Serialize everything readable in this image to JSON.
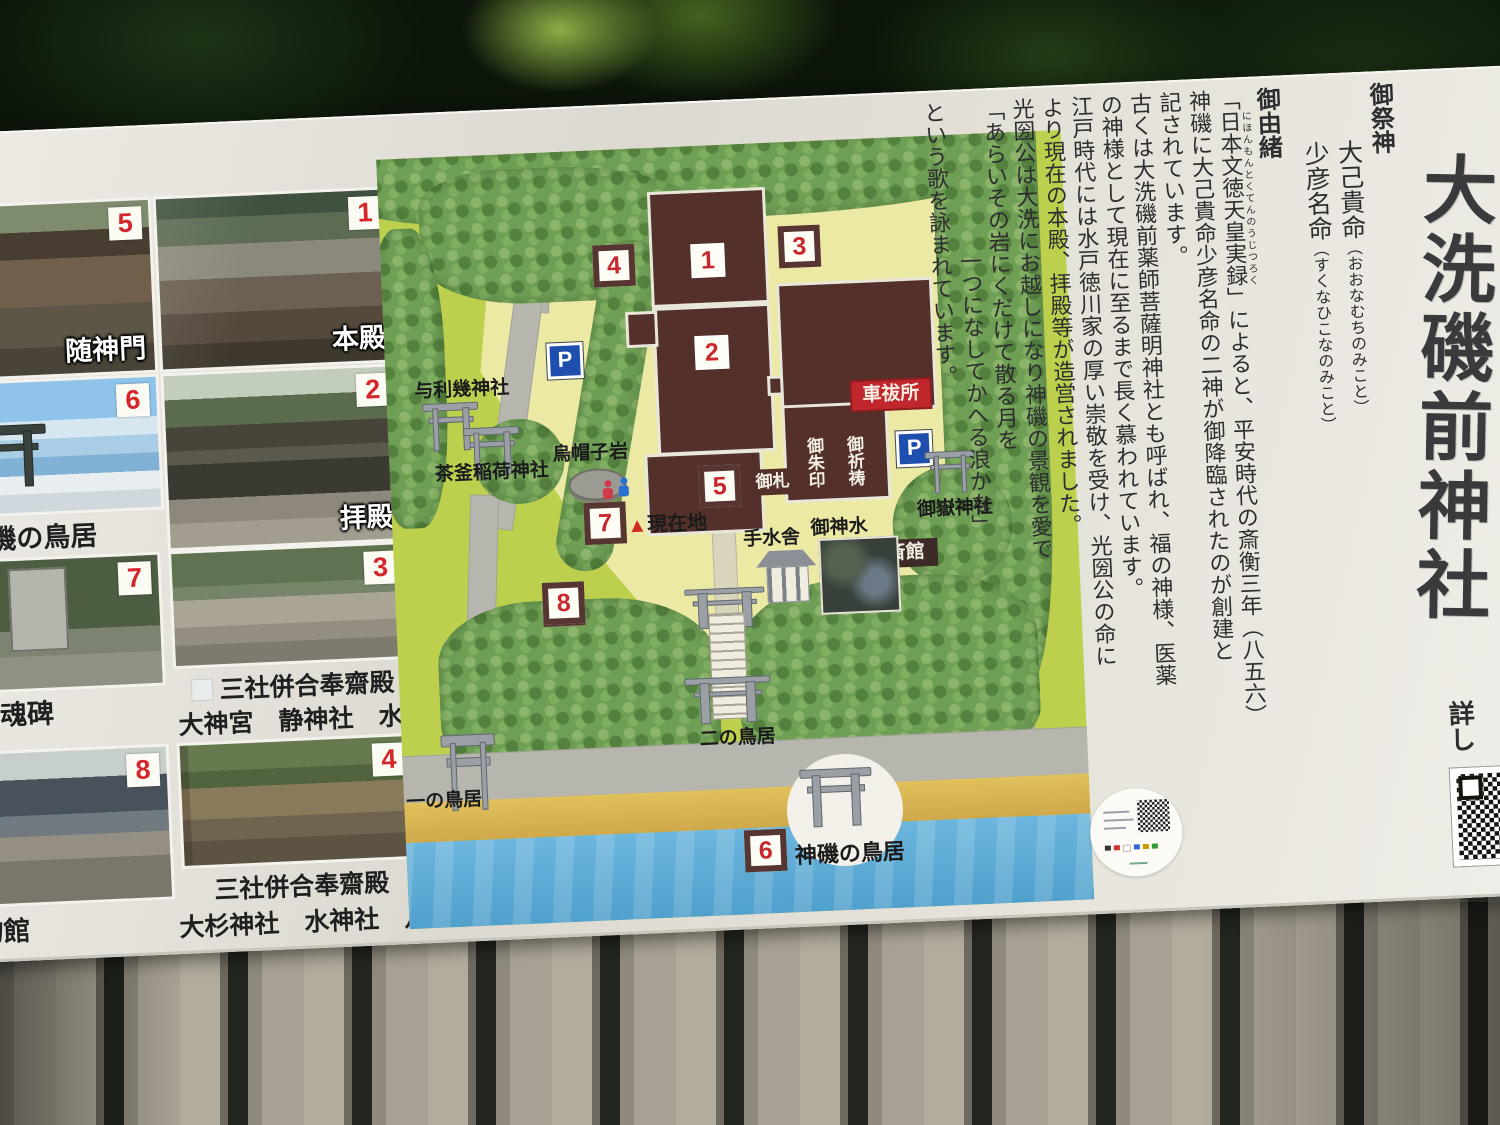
{
  "photos": {
    "p5": {
      "num": "5",
      "caption": "随神門"
    },
    "p1": {
      "num": "1",
      "caption": "本殿"
    },
    "p6": {
      "num": "6",
      "caption": "神磯の鳥居"
    },
    "p2": {
      "num": "2",
      "caption": "拝殿"
    },
    "p7": {
      "num": "7",
      "caption": "河忠魂碑"
    },
    "p3": {
      "num": "3",
      "caption_line1": "三社併合奉齋殿",
      "caption_line2": "大神宮　静神社　水天宮"
    },
    "p8": {
      "num": "8",
      "caption": "博物館"
    },
    "p4": {
      "num": "4",
      "caption_line1": "三社併合奉齋殿",
      "caption_line2": "大杉神社　水神社　八幡宮"
    }
  },
  "map": {
    "markers": {
      "n1": "1",
      "n2": "2",
      "n3": "3",
      "n4": "4",
      "n5": "5",
      "n6": "6",
      "n7": "7",
      "n8": "8"
    },
    "labels": {
      "yorigi": "与利幾神社",
      "chagama": "茶釜稲荷神社",
      "eboshi": "烏帽子岩",
      "genzaichi": "現在地",
      "ofuda": "御札",
      "goshuin": "御朱印",
      "gokito": "御祈祷",
      "kurumaharai": "車祓所",
      "parking": "P",
      "mitake": "御嶽神社",
      "temizusha": "手水舎",
      "goshinsui": "御神水",
      "saikan": "斎館",
      "ninotorii": "二の鳥居",
      "ichinotorii": "一の鳥居",
      "kamiiso": "神磯の鳥居"
    }
  },
  "rightpanel": {
    "title": "大洗磯前神社",
    "saijin_heading": "御祭神",
    "kami1_name": "大己貴命",
    "kami1_reading": "（おおなむちのみこと）",
    "kami2_name": "少彦名命",
    "kami2_reading": "（すくなひこなのみこと）",
    "yuisho_heading": "御由緒",
    "yuisho1_pre": "「",
    "yuisho1_ruby": "日本文徳天皇実録",
    "yuisho1_rt": "にほんもんとくてんのうじつろく",
    "yuisho1_post": "」によると、平安時代の斎衡三年（八五六）",
    "yuisho2": "神磯に大己貴命少彦名命の二神が御降臨されたのが創建と",
    "yuisho3": "記されています。",
    "yuisho4": "古くは大洗磯前薬師菩薩明神社とも呼ばれ、福の神様、医薬",
    "yuisho5": "の神様として現在に至るまで長く慕われています。",
    "yuisho6": "江戸時代には水戸徳川家の厚い崇敬を受け、光圀公の命に",
    "yuisho7": "より現在の本殿、拝殿等が造営されました。",
    "yuisho8": "光圀公は大洗にお越しになり神磯の景観を愛で",
    "poem1": "「あらいその岩にくだけて散る月を",
    "poem2": "一つになしてかへる浪かな」",
    "yuisho9": "という歌を詠まれています。",
    "more_info": "詳し"
  },
  "colors": {
    "badge_red": "#c8282d",
    "building_brown": "#533029",
    "grass_green": "#bdd04e",
    "sea_blue": "#5fb2dc",
    "parking_blue": "#1f4fae",
    "stamp_red": "#c0272d"
  }
}
